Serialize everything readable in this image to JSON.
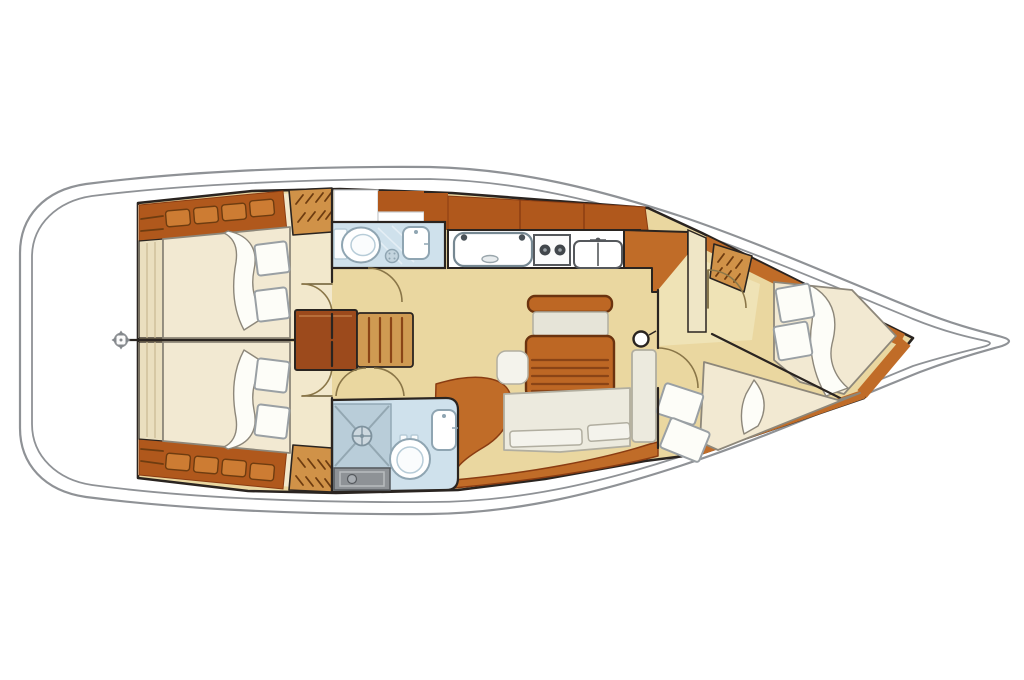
{
  "title": "Sailing yacht interior layout floor plan (top view)",
  "diagram_type": "boat-floor-plan",
  "palette": {
    "hullLine": "#8f9296",
    "outline": "#2a2420",
    "wood": "#c06c28",
    "woodDark": "#b0581c",
    "woodDeep": "#9c4a1c",
    "woodLight": "#cf9a52",
    "locker": "#d09248",
    "stitch": "#cd7c33",
    "hatch": "#6e3c10",
    "floor": "#ead7a0",
    "floorLight": "#f2e8cc",
    "floorFwd": "#efe3b6",
    "mattress": "#f2e9d2",
    "mattressEdge": "#8d877a",
    "pillow": "#fdfdf8",
    "pillowEdge": "#9aa0a4",
    "bath": "#cfe1ec",
    "bathDeep": "#b9cdd9",
    "fixtureEdge": "#8fa5b2",
    "grate": "#8e9296",
    "cushion": "#eceade",
    "cushionEdge": "#b1aea0",
    "tableTop": "#bd6724",
    "tableEdge": "#6b330f",
    "slat": "#8a4416",
    "wall": "#efe6c6",
    "doorArc": "#8a7648",
    "doorLeaf": "#6b5a33",
    "white": "#ffffff"
  },
  "components": [
    {
      "id": "hull-outline",
      "desc": "double hull and deck outline, bow to the right, transom stern to the left"
    },
    {
      "id": "compass-rose-icon",
      "desc": "small compass mark on the transom centerline"
    },
    {
      "id": "port-aft-cabin",
      "desc": "aft double cabin with berth, pillows, side shelf, hanging locker"
    },
    {
      "id": "starboard-aft-cabin",
      "desc": "mirrored aft double cabin"
    },
    {
      "id": "port-aft-head",
      "desc": "bathroom with toilet, washbasin and shower drain"
    },
    {
      "id": "starboard-aft-head",
      "desc": "bathroom with shower stall, floor grate, toilet and washbasin"
    },
    {
      "id": "galley",
      "desc": "galley with icebox, two-burner stove and double sink"
    },
    {
      "id": "nav-station",
      "desc": "chart table with slatted seat"
    },
    {
      "id": "saloon",
      "desc": "dining table with slatted top, bench, stool, L-shaped settee, mast post"
    },
    {
      "id": "forward-cabin",
      "desc": "bow cabin with island double berth, second diagonal berth, hanging locker"
    }
  ]
}
